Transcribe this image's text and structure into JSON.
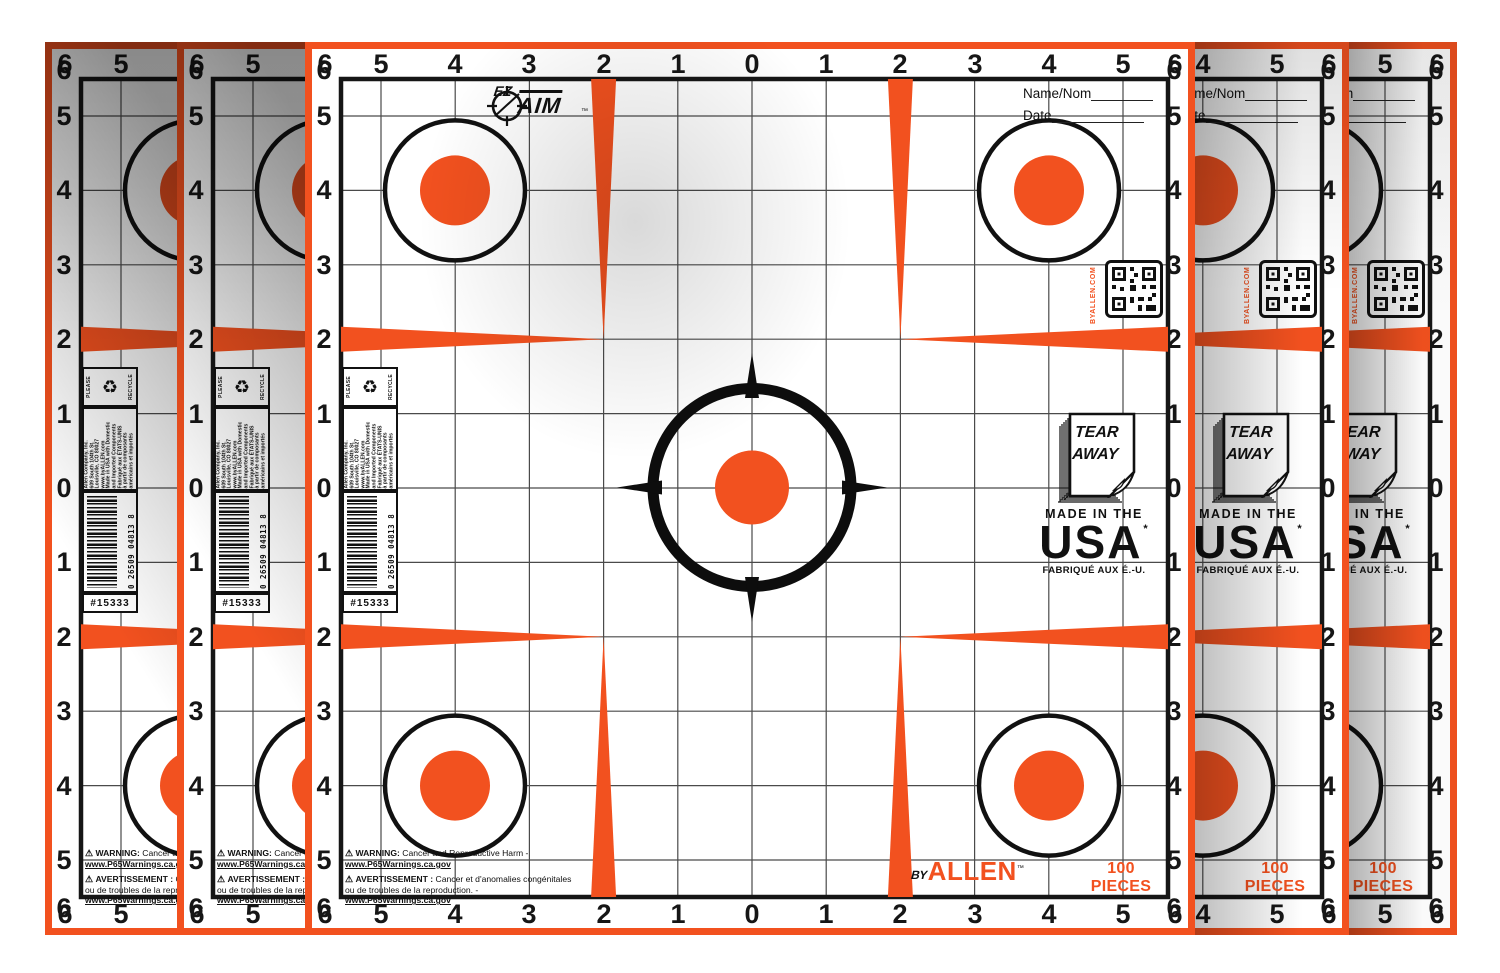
{
  "brand": {
    "ez": "EZ",
    "aim": "AIM",
    "tm": "™",
    "byallen_by": "BY",
    "byallen_allen": "ALLEN",
    "byallen_tm": "™",
    "byallen_com_vertical": "BYALLEN.COM"
  },
  "scale": {
    "values": [
      "6",
      "5",
      "4",
      "3",
      "2",
      "1",
      "0",
      "1",
      "2",
      "3",
      "4",
      "5",
      "6"
    ]
  },
  "header": {
    "name_label": "Name/Nom",
    "date_label": "Date"
  },
  "tear_away": {
    "line1": "TEAR",
    "line2": "AWAY"
  },
  "made_in": {
    "line1": "MADE IN THE",
    "line2": "USA",
    "usa_mark": "*",
    "line3": "FABRIQUÉ AUX É.-U."
  },
  "pieces_label": "100 PIECES",
  "recycle": {
    "left": "PLEASE",
    "right": "RECYCLE",
    "icon": "♻"
  },
  "company_block": {
    "lines": [
      "Allen Company, Inc.",
      "609 South 104th St.",
      "Louisville, CO 80027",
      "www.byALLEN.com",
      "Made in USA with Domestic",
      "and Imported Components",
      "Fabriqué aux ÉTATS-UNIS",
      "à partir de composants",
      "américains et importés"
    ]
  },
  "barcode": {
    "digits": "0 26509 04813 8",
    "sku": "#15333"
  },
  "warnings": {
    "warn_icon": "⚠",
    "en_label": "WARNING:",
    "en_text": "Cancer and Reproductive Harm -",
    "en_link": "www.P65Warnings.ca.gov",
    "fr_label": "AVERTISSEMENT :",
    "fr_text": "Cancer et d'anomalies congénitales ou de troubles de la reproduction. -",
    "fr_link": "www.P65Warnings.ca.gov"
  },
  "colors": {
    "accent_orange": "#F2511F",
    "ink_black": "#111111",
    "grid_gray": "#4a4a4a"
  }
}
